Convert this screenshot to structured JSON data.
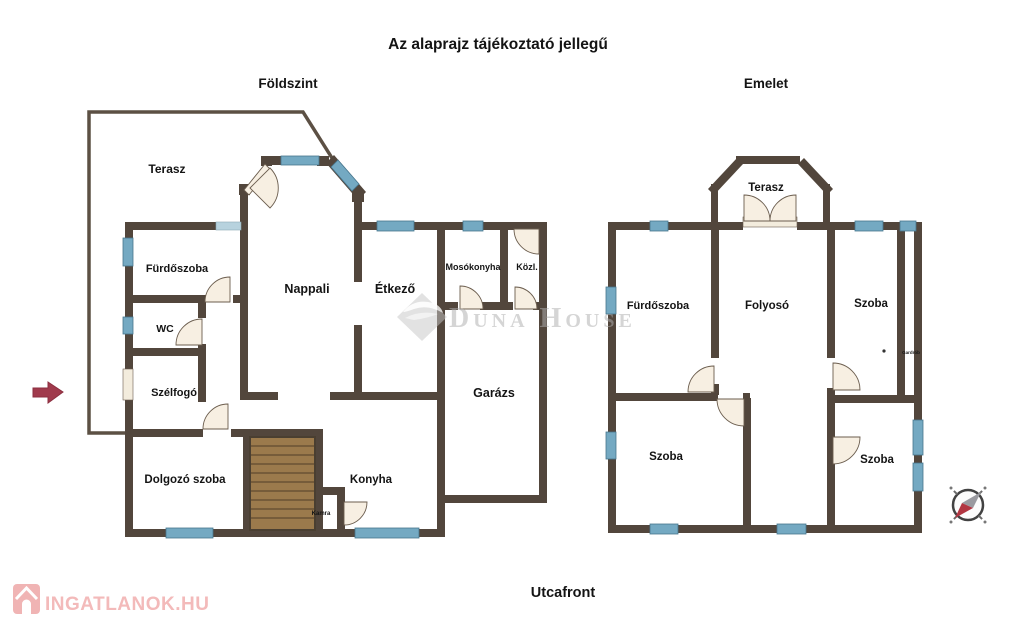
{
  "title": "Az alaprajz tájékoztató jellegű",
  "street_front_label": "Utcafront",
  "ground_floor": {
    "label": "Földszint",
    "rooms": {
      "terasz": "Terasz",
      "furdoszoba": "Fürdőszoba",
      "wc": "WC",
      "szelfogo": "Szélfogó",
      "nappali": "Nappali",
      "etkezo": "Étkező",
      "mosokonyha": "Mosókonyha",
      "kozlekedo": "Közl.",
      "garazs": "Garázs",
      "dolgozo_szoba": "Dolgozó szoba",
      "konyha": "Konyha",
      "kamra": "Kamra"
    }
  },
  "upper_floor": {
    "label": "Emelet",
    "rooms": {
      "terasz": "Terasz",
      "furdoszoba": "Fürdőszoba",
      "folyoso": "Folyosó",
      "szoba_jobb_felso": "Szoba",
      "szoba_bal_also": "Szoba",
      "szoba_jobb_also": "Szoba",
      "gardrob": "Gardrób"
    }
  },
  "watermarks": {
    "agency": "Duna House",
    "portal": "INGATLANOK.HU"
  },
  "colors": {
    "wall": "#52463c",
    "window": "#74a9c2",
    "door_fill": "#f7efe2",
    "stairs": "#9b7a4c",
    "entrance_arrow": "#a03a4c",
    "compass_needle_red": "#b23642",
    "watermark_gray": "#b0b0b0",
    "portal_pink": "#f3baba"
  }
}
